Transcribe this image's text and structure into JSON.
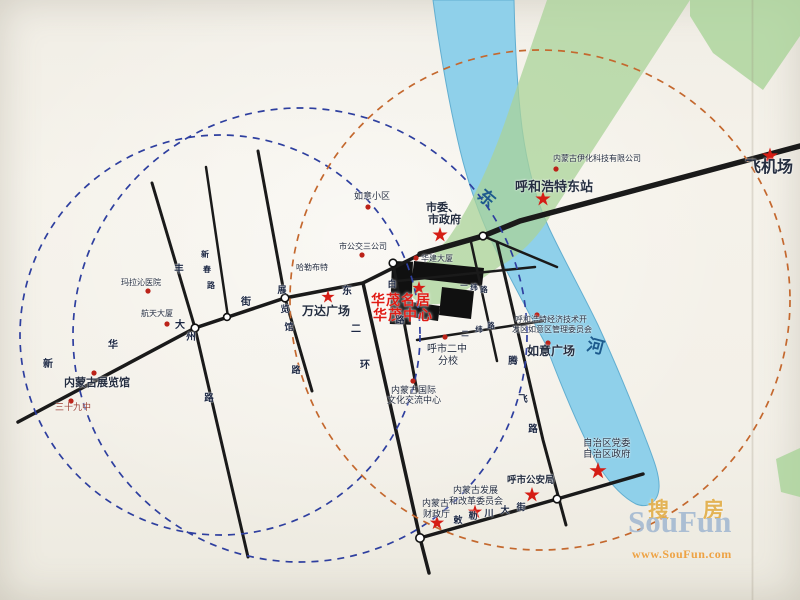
{
  "site": {
    "line1": "华茂名居",
    "line2": "华茂中心"
  },
  "river": {
    "dong": "东",
    "he": "河"
  },
  "road_chars": {
    "xinhua_street": [
      "新",
      "华",
      "大",
      "街"
    ],
    "fengzhou_road": [
      "丰",
      "州",
      "路"
    ],
    "xinchun_road": [
      "新",
      "春",
      "路"
    ],
    "zhanlanguan_road": [
      "展",
      "览",
      "馆",
      "路"
    ],
    "east_2nd_ring": [
      "东",
      "二",
      "环"
    ],
    "bai_road": [
      "白",
      "路"
    ],
    "yiwei_road": [
      "一",
      "纬",
      "路"
    ],
    "erwei_road": [
      "二",
      "纬",
      "路"
    ],
    "tengfei_road": [
      "腾",
      "飞",
      "路"
    ],
    "chilechuan_street": [
      "敕",
      "勒",
      "川",
      "大",
      "街"
    ]
  },
  "places": {
    "airport": "飞机场",
    "east_station": "呼和浩特东站",
    "yihua_company": "内蒙古伊化科技有限公司",
    "city_gov": [
      "市委、",
      "市政府"
    ],
    "ruyi_estate": "如意小区",
    "bus_company": "市公交三公司",
    "halebute": "哈勒布特",
    "wanda_plaza": "万达广场",
    "malaqin_hospital": "玛拉沁医院",
    "hangtian_tower": "航天大厦",
    "exhibition_hall": "内蒙古展览馆",
    "school_39": "三十九中",
    "huajian_tower": "华建大厦",
    "no2_school": [
      "呼市二中",
      "分校"
    ],
    "intl_center": [
      "内蒙古国际",
      "文化交流中心"
    ],
    "ruyi_square": "如意广场",
    "edz_committee": [
      "呼和浩特经济技术开",
      "发区如意区管理委员会"
    ],
    "region_gov": [
      "自治区党委",
      "自治区政府"
    ],
    "police": "呼市公安局",
    "ndrc": [
      "内蒙古发展",
      "和改革委员会"
    ],
    "finance": [
      "内蒙古",
      "财政厅"
    ]
  },
  "watermark": {
    "cn": "搜房",
    "en": "SouFun",
    "url": "www.SouFun.com"
  },
  "colors": {
    "site_red": "#e01b14",
    "poi_red": "#bb2218",
    "dash_blue": "#2e3f9f",
    "dash_orange": "#c4682e",
    "river_blue": "#8fd0ea",
    "green_area": "#a9d398",
    "road_black": "#1a1a1a"
  }
}
